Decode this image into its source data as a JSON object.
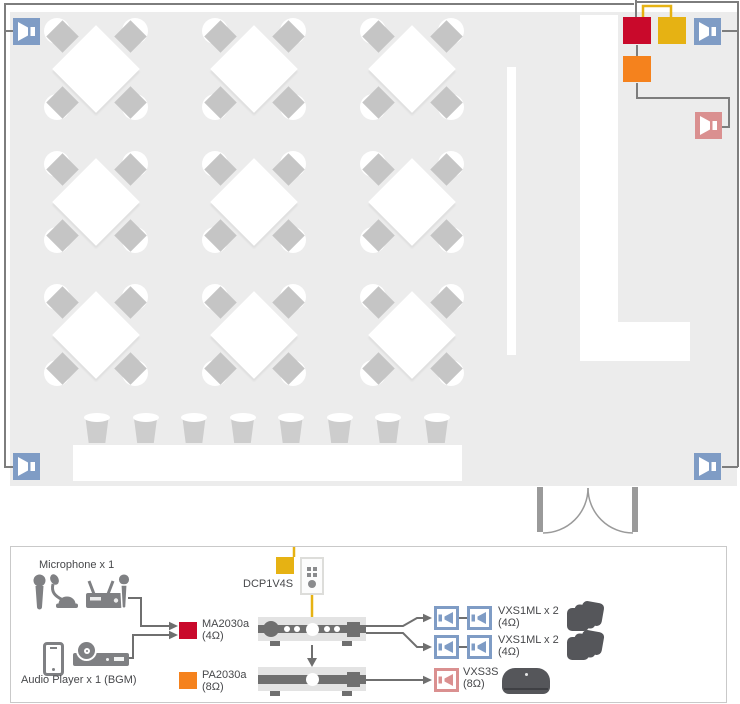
{
  "diagram": {
    "mic_group_label": "Microphone x 1",
    "player_group_label": "Audio Player x 1 (BGM)",
    "controller": {
      "name": "DCP1V4S"
    },
    "amp1": {
      "name": "MA2030a",
      "impedance": "(4Ω)"
    },
    "amp2": {
      "name": "PA2030a",
      "impedance": "(8Ω)"
    },
    "out1": {
      "name": "VXS1ML x 2",
      "impedance": "(4Ω)"
    },
    "out2": {
      "name": "VXS1ML x 2",
      "impedance": "(4Ω)"
    },
    "out3": {
      "name": "VXS3S",
      "impedance": "(8Ω)"
    },
    "colors": {
      "red": "#c9092b",
      "yellow": "#e6b213",
      "orange": "#f5821d",
      "blue": "#7f9cc5",
      "pink": "#da9090",
      "wire": "#7d7d7d",
      "door": "#9a9a9a",
      "floor": "#ececec",
      "text": "#47484b"
    },
    "icons": {
      "handheld_mic": "handheld-mic-icon",
      "gooseneck_mic": "gooseneck-mic-icon",
      "wireless_receiver": "wireless-receiver-icon",
      "smartphone": "smartphone-icon",
      "cd_player": "cd-player-icon",
      "wall_controller": "wall-controller-icon",
      "corner_speaker": "speaker-icon",
      "surface_speaker": "speaker-icon"
    }
  }
}
